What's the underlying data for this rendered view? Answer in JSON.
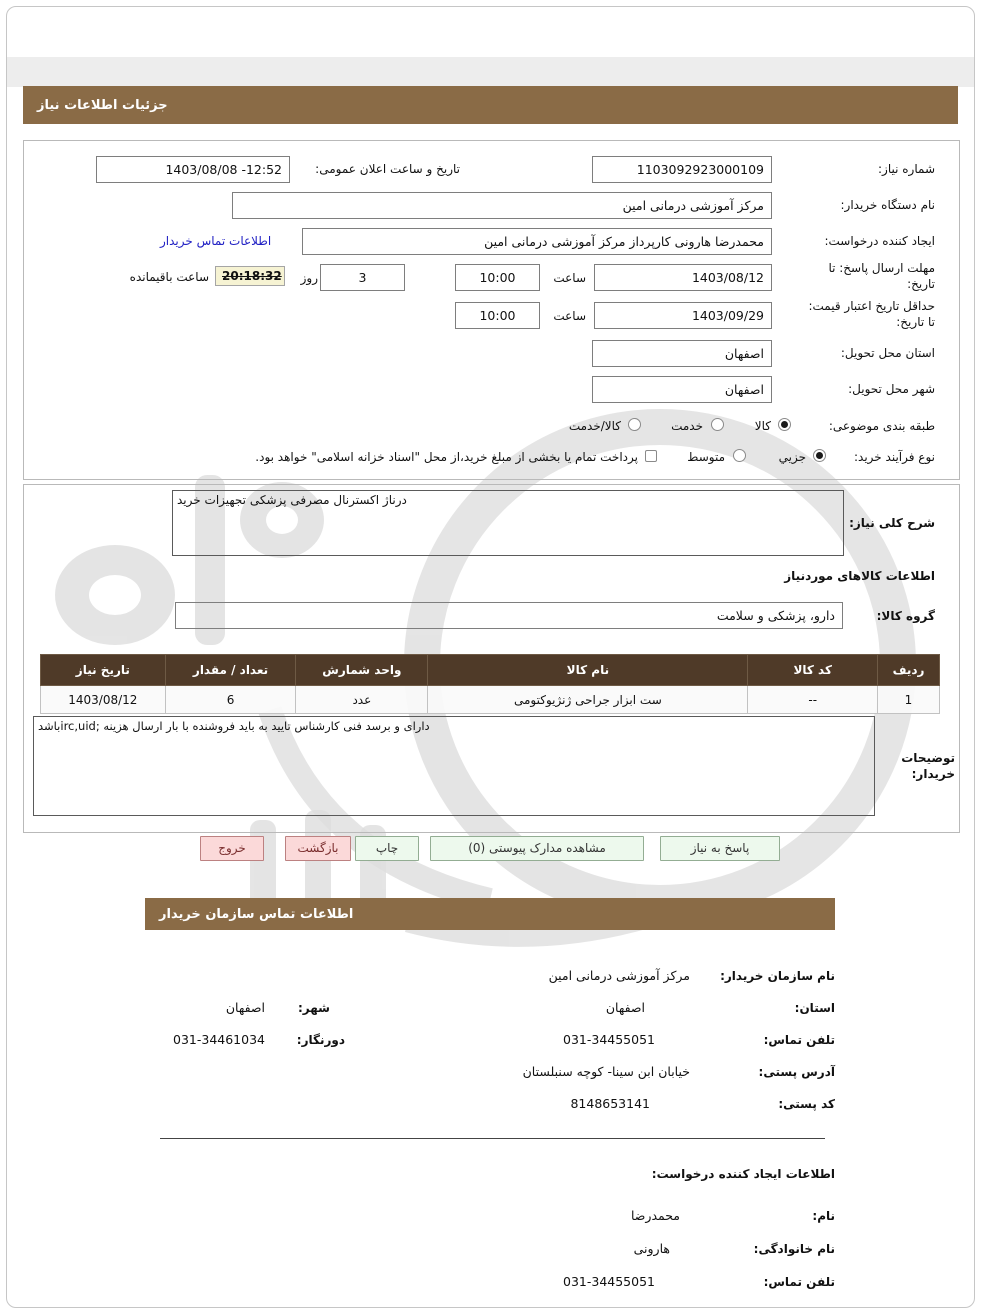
{
  "page": {
    "title_bar": "جزئیات اطلاعات نیاز",
    "contact_bar": "اطلاعات تماس سازمان خریدار"
  },
  "colors": {
    "accent_brown": "#8a6b46",
    "table_header_brown": "#4f3a28",
    "button_pink": "#fbd9d9",
    "button_green": "#edf9ed",
    "link_blue": "#2121c4",
    "countdown_bg": "#f6f3d3"
  },
  "details": {
    "need_no_label": "شماره نیاز:",
    "need_no": "1103092923000109",
    "announce_label": "تاریخ و ساعت اعلان عمومی:",
    "announce": "1403/08/08 -12:52",
    "buyer_org_label": "نام دستگاه خریدار:",
    "buyer_org": "مرکز آموزشی درمانی امین",
    "creator_label": "ایجاد کننده درخواست:",
    "creator": "محمدرضا هارونی کارپرداز مرکز آموزشی درمانی امین",
    "buyer_contact_link": "اطلاعات تماس خریدار",
    "reply_deadline_label": "مهلت ارسال پاسخ: تا تاریخ:",
    "reply_date": "1403/08/12",
    "hour_label": "ساعت",
    "reply_time": "10:00",
    "days": "3",
    "day_label": "روز",
    "countdown": "20:18:32",
    "remaining_label": "ساعت باقیمانده",
    "price_valid_label": "حداقل تاریخ اعتبار قیمت: تا تاریخ:",
    "price_date": "1403/09/29",
    "price_time": "10:00",
    "province_label": "استان محل تحویل:",
    "province": "اصفهان",
    "city_label": "شهر محل تحویل:",
    "city": "اصفهان",
    "category_label": "طبقه بندی موضوعی:",
    "cat_options": [
      "کالا",
      "خدمت",
      "کالا/خدمت"
    ],
    "cat_selected": "کالا",
    "process_label": "نوع فرآیند خرید:",
    "proc_options": [
      "جزیي",
      "متوسط"
    ],
    "proc_selected": "جزیي",
    "treasury_note": "پرداخت تمام یا بخشی از مبلغ خرید،از محل \"اسناد خزانه اسلامی\" خواهد بود."
  },
  "need": {
    "label": "شرح کلی نیاز:",
    "text": "خرید‎ تجهیزات‎ پزشکی‎ مصرفی‎ اکسترنال‎ درناژ"
  },
  "goods": {
    "section_title": "اطلاعات کالاهای موردنیاز",
    "group_label": "گروه کالا:",
    "group": "دارو، پزشکی و سلامت",
    "table": {
      "headers": [
        "ردیف",
        "کد کالا",
        "نام کالا",
        "واحد شمارش",
        "تعداد / مقدار",
        "تاریخ نیاز"
      ],
      "row": [
        "1",
        "--",
        "ست ابزار جراحی ژنژیوکتومی",
        "عدد",
        "6",
        "1403/08/12"
      ]
    }
  },
  "notes": {
    "label": "توضیحات خریدار:",
    "text": "باشد‎irc,uid; هزینه‎ ارسال‎ بار‎ با‎ فروشنده‎ باید‎ به‎ تایید‎ کارشناس‎ فنی‎ برسد‎ و‎ دارای"
  },
  "buttons": {
    "exit": "خروج",
    "back": "بازگشت",
    "print": "چاپ",
    "attachments": "مشاهده مدارک پیوستی (0)",
    "reply": "پاسخ به نیاز"
  },
  "org": {
    "name_label": "نام سازمان خریدار:",
    "name": "مرکز آموزشی درمانی امین",
    "province_label": "استان:",
    "province": "اصفهان",
    "city_label": "شهر:",
    "city": "اصفهان",
    "phone_label": "تلفن تماس:",
    "phone": "031-34455051",
    "fax_label": "دورنگار:",
    "fax": "031-34461034",
    "address_label": "آدرس پستی:",
    "address": "خیابان ابن سینا- کوچه سنبلستان",
    "zip_label": "کد پستی:",
    "zip": "8148653141"
  },
  "creator": {
    "heading": "اطلاعات ایجاد کننده درخواست:",
    "first_label": "نام:",
    "first": "محمدرضا",
    "last_label": "نام خانوادگی:",
    "last": "هارونی",
    "phone_label": "تلفن تماس:",
    "phone": "031-34455051"
  }
}
